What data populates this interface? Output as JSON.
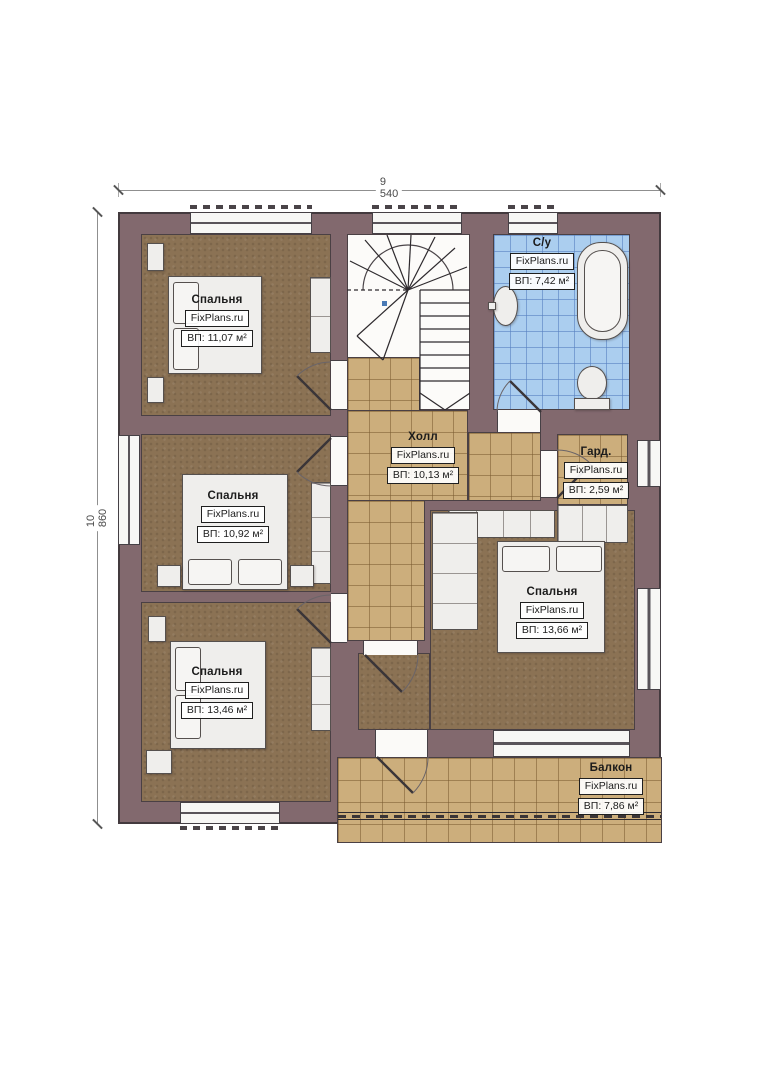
{
  "dimensions": {
    "top": "9 540",
    "left": "10 860"
  },
  "rooms": [
    {
      "key": "bedroom-top-left",
      "name": "Спальня",
      "watermark": "FixPlans.ru",
      "area": "ВП: 11,07 м²"
    },
    {
      "key": "bedroom-mid-left",
      "name": "Спальня",
      "watermark": "FixPlans.ru",
      "area": "ВП: 10,92 м²"
    },
    {
      "key": "bedroom-bottom-left",
      "name": "Спальня",
      "watermark": "FixPlans.ru",
      "area": "ВП: 13,46 м²"
    },
    {
      "key": "hall",
      "name": "Холл",
      "watermark": "FixPlans.ru",
      "area": "ВП: 10,13 м²"
    },
    {
      "key": "bathroom",
      "name": "С/у",
      "watermark": "FixPlans.ru",
      "area": "ВП: 7,42 м²"
    },
    {
      "key": "wardrobe",
      "name": "Гард.",
      "watermark": "FixPlans.ru",
      "area": "ВП: 2,59 м²"
    },
    {
      "key": "bedroom-right",
      "name": "Спальня",
      "watermark": "FixPlans.ru",
      "area": "ВП: 13,66 м²"
    },
    {
      "key": "balcony",
      "name": "Балкон",
      "watermark": "FixPlans.ru",
      "area": "ВП: 7,86 м²"
    }
  ],
  "colors": {
    "wall": "#82696e",
    "wall_outline": "#433a3e",
    "bedroom_floor": "#8b7254",
    "tile_floor": "#ccae7c",
    "bath_tile": "#abceef",
    "furniture": "#efeeec",
    "walkline_dot": "#4a7ab5"
  }
}
